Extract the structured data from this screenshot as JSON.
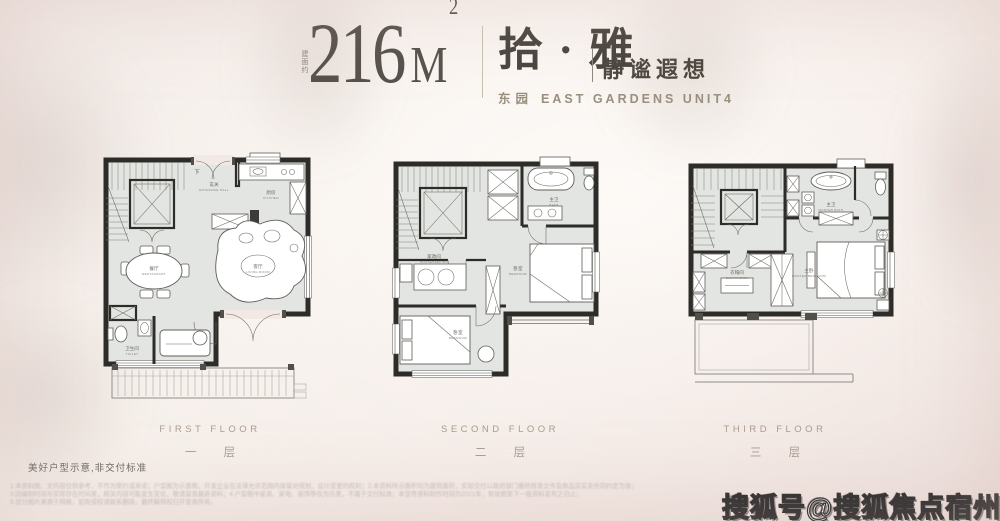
{
  "header": {
    "area_prefix": "建面约",
    "area_number": "216",
    "area_unit": "M",
    "area_sup": "2",
    "name_cn": "拾 · 雅",
    "tagline": "静谧遐想",
    "subtitle_cn": "东园",
    "subtitle_en": "EAST GARDENS UNIT4"
  },
  "floors": [
    {
      "label_en": "FIRST FLOOR",
      "label_cn": "一 层",
      "stair_mark": "下",
      "rooms": [
        {
          "cn": "玄关",
          "en": "ENTRANCE HALL"
        },
        {
          "cn": "厨房",
          "en": "KITCHEN"
        },
        {
          "cn": "餐厅",
          "en": "RESTAURANT"
        },
        {
          "cn": "客厅",
          "en": "LIVING ROOM"
        },
        {
          "cn": "卫生间",
          "en": "TOILET"
        }
      ]
    },
    {
      "label_en": "SECOND FLOOR",
      "label_cn": "二 层",
      "rooms": [
        {
          "cn": "主卫",
          "en": "BATH"
        },
        {
          "cn": "卧室",
          "en": "BEDROOM"
        },
        {
          "cn": "家政间",
          "en": "HOUSEKEEPING"
        },
        {
          "cn": "卧室",
          "en": "BEDROOM"
        }
      ]
    },
    {
      "label_en": "THIRD FLOOR",
      "label_cn": "三 层",
      "rooms": [
        {
          "cn": "主卫",
          "en": "MASTER BATH"
        },
        {
          "cn": "衣帽间",
          "en": "CLOAKROOM"
        },
        {
          "cn": "主卧",
          "en": "MASTER BEDROOM"
        }
      ]
    }
  ],
  "footnote": "美好户型示意,非交付标准",
  "fine_print": [
    "1.本资料图、文内容仅供参考，不作为要约或承诺；户型图为示意图，开发企业在法律允许范围内保留对规划、设计变更的权利；2.本资料所示面积均为建筑面积，实际交付以政府部门最终核准文件及商品房买卖合同约定为准；",
    "3.因编制时间与实际存在时间差，相关内容可能发生变化，敬请留意最新资料；4.户型图中家具、家电、装饰等仅为示意，不属于交付标准；本宣传资料制作时间为2021年，有效期至下一版资料发布之日止；",
    "5.部分图片来源于网络，如有侵权请联系删除，最终解释权归开发商所有。"
  ],
  "watermark": "搜狐号@搜狐焦点宿州站",
  "colors": {
    "background": "#f2e9e4",
    "wall": "#2d2c29",
    "floor_fill": "#e2e5e1",
    "title_text": "#55504a",
    "muted_text": "#a79e90",
    "watermark_fill": "#ffffff",
    "watermark_outline": "#2a2a2a"
  }
}
